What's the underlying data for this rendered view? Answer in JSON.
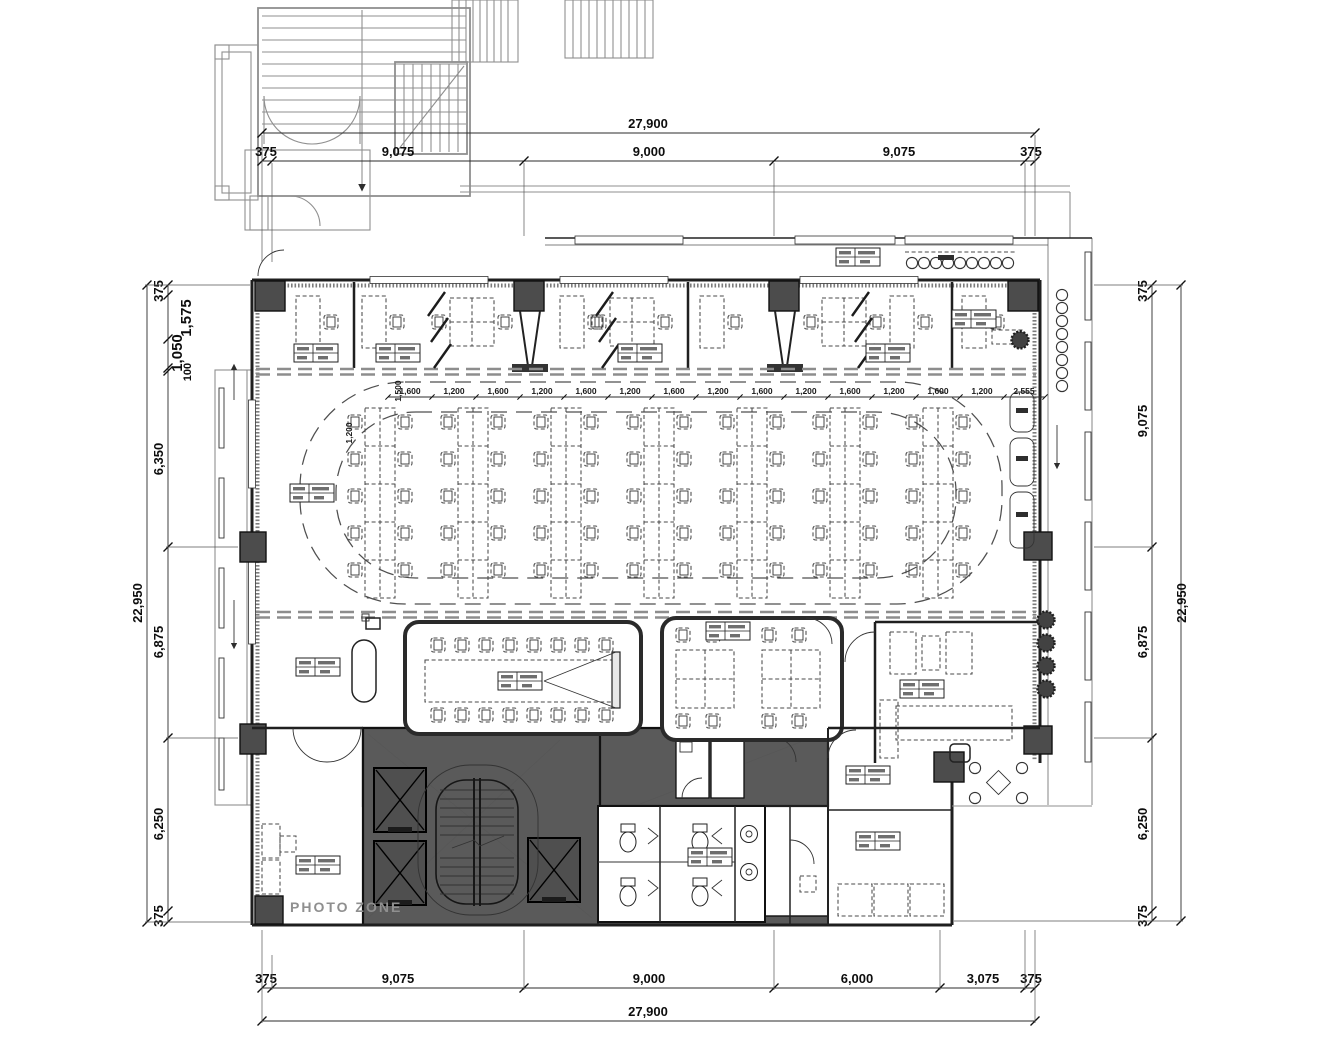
{
  "drawing": {
    "type": "architectural-office-floor-plan",
    "labels": {
      "photo_zone": "PHOTO ZONE"
    },
    "colors": {
      "wall": "#1f1f1f",
      "core_fill": "#5a5a5a",
      "column_fill": "#4c4c4c",
      "secondary_structure": "#8f8f8f",
      "dimension_text": "#0d0d0d",
      "muted_label": "#8f8f8f",
      "background": "#ffffff"
    }
  },
  "dims": {
    "top": {
      "total": "27,900",
      "segments": [
        "375",
        "9,075",
        "9,000",
        "9,075",
        "375"
      ]
    },
    "bottom": {
      "total": "27,900",
      "segments": [
        "375",
        "9,075",
        "9,000",
        "6,000",
        "3,075",
        "375"
      ]
    },
    "left": {
      "total": "22,950",
      "segments": [
        "375",
        "1,575",
        "1,050",
        "100",
        "6,350",
        "6,875",
        "6,250",
        "375"
      ]
    },
    "right": {
      "total": "22,950",
      "segments": [
        "375",
        "9,075",
        "6,875",
        "6,250",
        "375"
      ]
    }
  },
  "interior_dims": {
    "desk_row": [
      "1,600",
      "1,200",
      "1,600",
      "1,200",
      "1,600",
      "1,200",
      "1,600",
      "1,200",
      "1,600",
      "1,200",
      "1,600",
      "1,200",
      "1,600",
      "1,200",
      "2,555"
    ],
    "desk_col_pitch": "1,500",
    "desk_depth": "1,200"
  }
}
